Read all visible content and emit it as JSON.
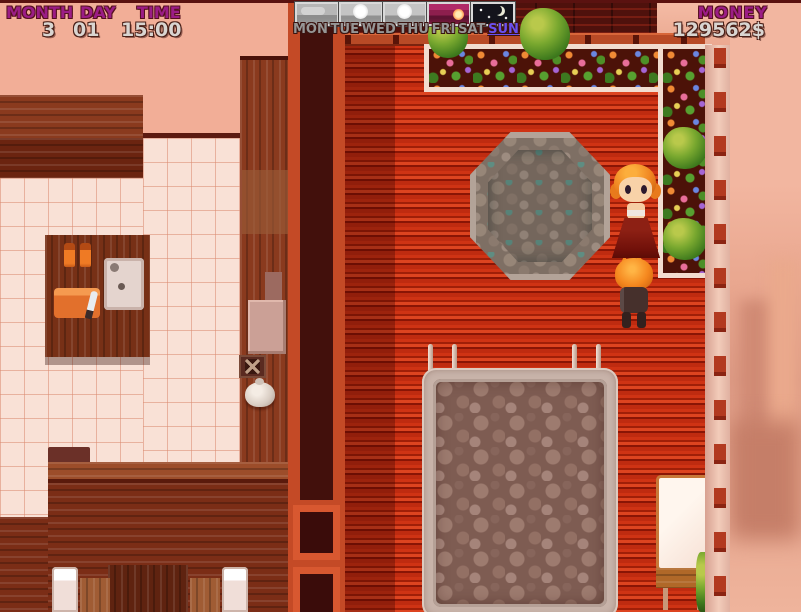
{
  "hud": {
    "date_panel": {
      "month_label": "MONTH",
      "day_label": "DAY",
      "time_label": "TIME",
      "month_value": "3",
      "day_value": "01",
      "time_value": "15:00"
    },
    "week_bar": {
      "days": [
        {
          "label": "MON",
          "active": false
        },
        {
          "label": "TUE",
          "active": false
        },
        {
          "label": "WED",
          "active": false
        },
        {
          "label": "THU",
          "active": false
        },
        {
          "label": "FRI",
          "active": false
        },
        {
          "label": "SAT",
          "active": false
        },
        {
          "label": "SUN",
          "active": true
        }
      ],
      "forecast_icons": [
        "overcast",
        "sunny",
        "sunny",
        "sunset",
        "night"
      ]
    },
    "money_panel": {
      "label": "MONEY",
      "value": "129562$"
    }
  },
  "colors": {
    "hud_label_purple": "#9b1d86",
    "hud_value_gray": "#d9d5d1",
    "active_day_blue": "#6a50f0",
    "deck_red": "#c22c10",
    "interior_wall_pink": "#f2ae97",
    "tile_floor": "#f9e1d6",
    "stone_gray": "#a89888"
  }
}
